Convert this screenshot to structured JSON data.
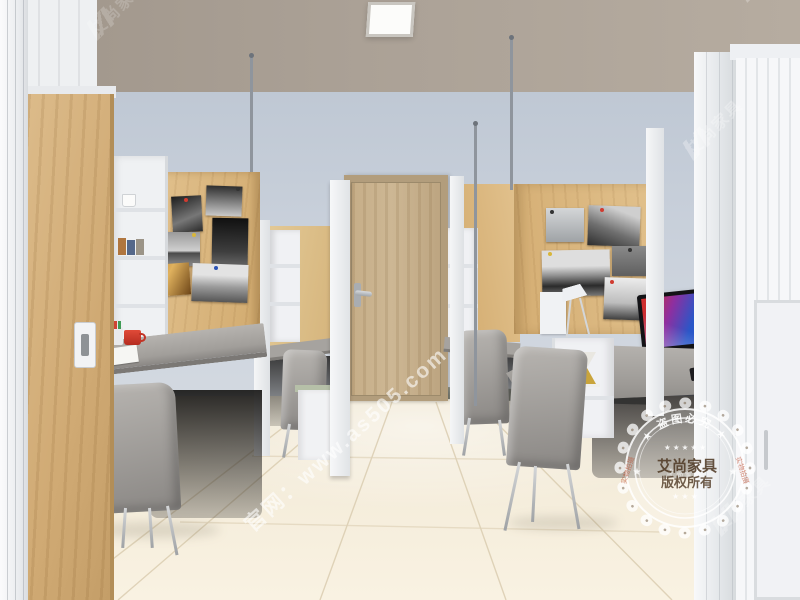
{
  "watermarks": {
    "site": "官网：www.as505.com",
    "brand": "艾尚家具",
    "seal": {
      "top_arc": "★ 盗图必究 ★",
      "stars_top": "★ ★ ★ ★ ★",
      "center_line1": "艾尚家具",
      "center_line2": "版权所有",
      "stars_bottom": "★ ★ ★",
      "bottom_arc": "艾尚家具",
      "side_left": "实物拍摄",
      "side_right": "实物拍摄",
      "star_left": "★",
      "star_right": "★"
    }
  },
  "palette": {
    "accent_orange": "#F0A125",
    "wood_light": "#DDBB87",
    "wall_blue_gray": "#C9D0DA",
    "ceiling_taupe": "#ABA196",
    "floor_cream": "#F3EBD9",
    "frame_white": "#EFF1F3",
    "desk_gray": "#A5A29E",
    "chair_gray": "#908D89",
    "door_wood": "#C4AD8C",
    "shadow_dark": "#2A2927",
    "mug_red": "#D23A2C",
    "monitor_red": "#CF2F2F",
    "monitor_blue": "#2A57C8",
    "metal_gray": "#9AA0A8",
    "watermark_white": "#FFFFFF"
  }
}
